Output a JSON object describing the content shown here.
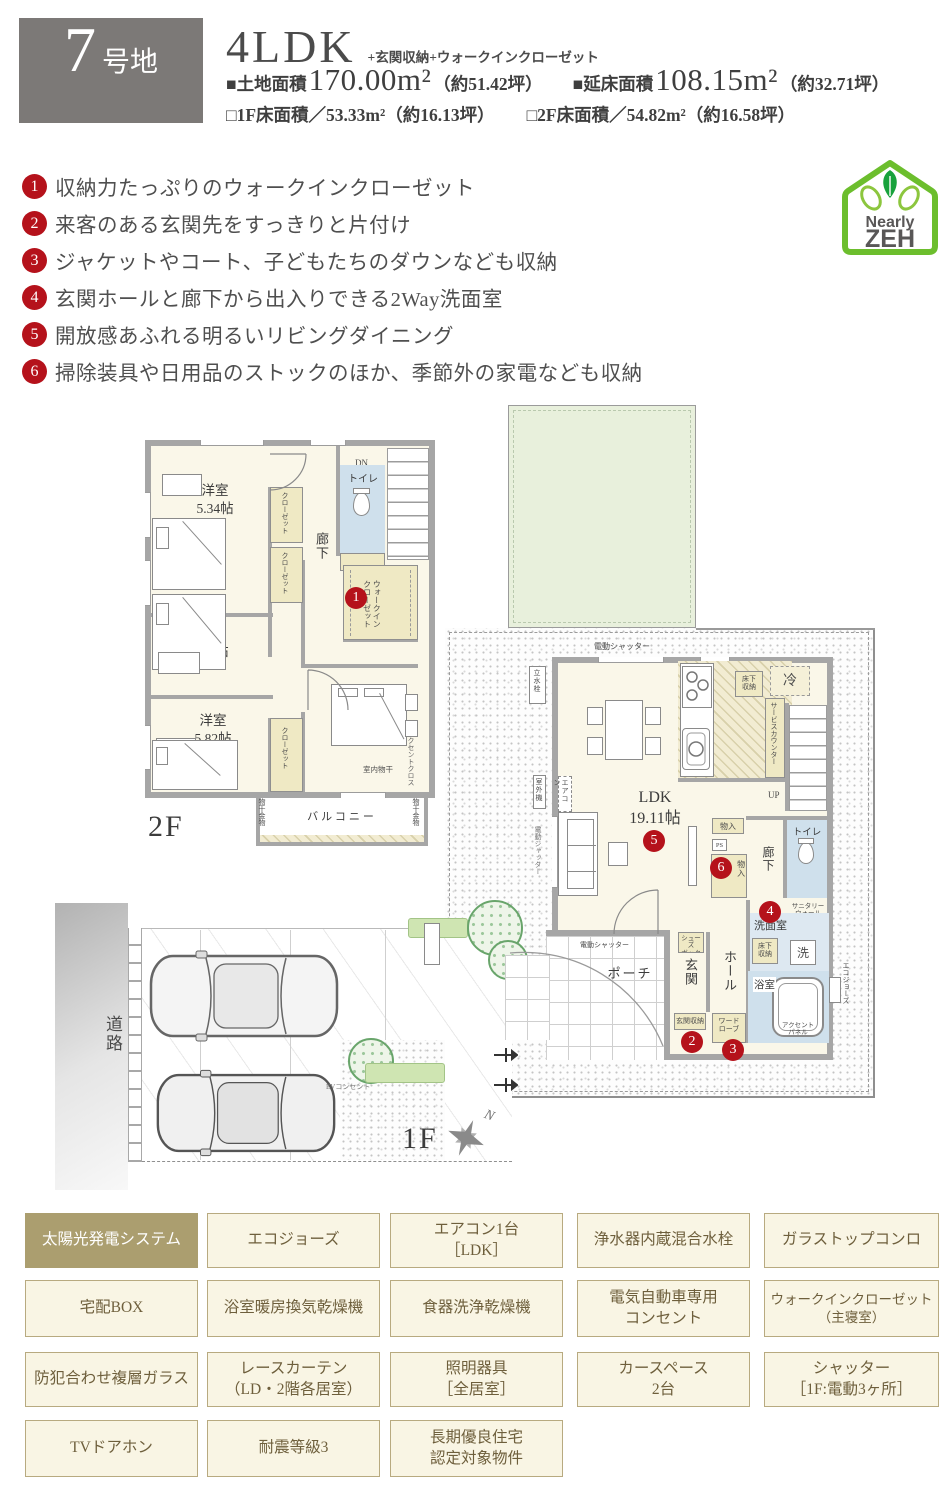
{
  "colors": {
    "badge_red": "#b5121b",
    "zeh_green": "#6cbe2d",
    "zeh_text_gray": "#595757",
    "wall_gray": "#a6a6a6",
    "tag_text_brown": "#6e5f3c",
    "tag_bg": "#f9f5e4",
    "tag_highlight": "#ab9e6f",
    "closet_yellow": "#efe9c4",
    "water_blue": "#cfe0ec",
    "garden_green": "#e8f0dc"
  },
  "header": {
    "lot_number": "7",
    "lot_suffix": "号地",
    "plan_type": "4LDK",
    "plan_options": "+玄関収納+ウォークインクローゼット",
    "land_label": "■土地面積",
    "land_value": "170.00m²",
    "land_tsubo": "（約51.42坪）",
    "total_label": "■延床面積",
    "total_value": "108.15m²",
    "total_tsubo": "（約32.71坪）",
    "f1_line": "□1F床面積／53.33m²（約16.13坪）",
    "f2_line": "□2F床面積／54.82m²（約16.58坪）"
  },
  "features": [
    {
      "num": "1",
      "text": "収納力たっぷりのウォークインクローゼット"
    },
    {
      "num": "2",
      "text": "来客のある玄関先をすっきりと片付け"
    },
    {
      "num": "3",
      "text": "ジャケットやコート、子どもたちのダウンなども収納"
    },
    {
      "num": "4",
      "text": "玄関ホールと廊下から出入りできる2Way洗面室"
    },
    {
      "num": "5",
      "text": "開放感あふれる明るいリビングダイニング"
    },
    {
      "num": "6",
      "text": "掃除装具や日用品のストックのほか、季節外の家電なども収納"
    }
  ],
  "zeh": {
    "line1": "Nearly",
    "line2": "ZEH"
  },
  "floor2": {
    "label": "2F",
    "room_534": "洋室\n5.34帖",
    "room_474": "洋室\n4.74帖",
    "room_582": "洋室\n5.82帖",
    "master": "主寝室\n6.46帖",
    "wic": "ウォークイン\nクローゼット",
    "closet": "クローゼット",
    "hallway": "廊下",
    "toilet": "トイレ",
    "dn": "DN",
    "balcony": "バルコニー",
    "hanger": "物干金物",
    "indoor_drying": "室内物干",
    "accent_cloth": "アクセントクロス"
  },
  "floor1": {
    "label": "1F",
    "ldk": "LDK\n19.11帖",
    "fridge": "冷",
    "underfloor": "床下\n収納",
    "service_counter": "サービスカウンター",
    "up": "UP",
    "storage": "物入",
    "ps": "PS",
    "hallway": "廊下",
    "toilet": "トイレ",
    "sanitary_wall": "サニタリー\nウォール",
    "washroom": "洗面室",
    "washer": "洗",
    "bath": "浴室",
    "accent_panel": "アクセント\nパネル",
    "ecojozu": "エコジョーズ",
    "shoe_box": "シューズ\nボックス",
    "entrance": "玄関",
    "hall": "ホール",
    "entrance_storage": "玄関収納",
    "wardrobe": "ワード\nローブ",
    "porch": "ポーチ",
    "shutter": "電動シャッター",
    "tap": "立水栓",
    "aircon": "エアコン",
    "outdoor_unit": "室外機",
    "ev_outlet": "EVコンセント",
    "road": "道路",
    "north": "N"
  },
  "tags": {
    "items": [
      {
        "label": "太陽光発電システム",
        "highlight": true
      },
      {
        "label": "エコジョーズ"
      },
      {
        "label": "エアコン1台\n［LDK］"
      },
      {
        "label": "浄水器内蔵混合水栓"
      },
      {
        "label": "ガラストップコンロ"
      },
      {
        "label": "宅配BOX"
      },
      {
        "label": "浴室暖房換気乾燥機"
      },
      {
        "label": "食器洗浄乾燥機"
      },
      {
        "label": "電気自動車専用\nコンセント"
      },
      {
        "label": "ウォークインクローゼット\n（主寝室）"
      },
      {
        "label": "防犯合わせ複層ガラス"
      },
      {
        "label": "レースカーテン\n（LD・2階各居室）"
      },
      {
        "label": "照明器具\n［全居室］"
      },
      {
        "label": "カースペース\n2台"
      },
      {
        "label": "シャッター\n［1F:電動3ヶ所］"
      },
      {
        "label": "TVドアホン"
      },
      {
        "label": "耐震等級3"
      },
      {
        "label": "長期優良住宅\n認定対象物件"
      }
    ]
  }
}
